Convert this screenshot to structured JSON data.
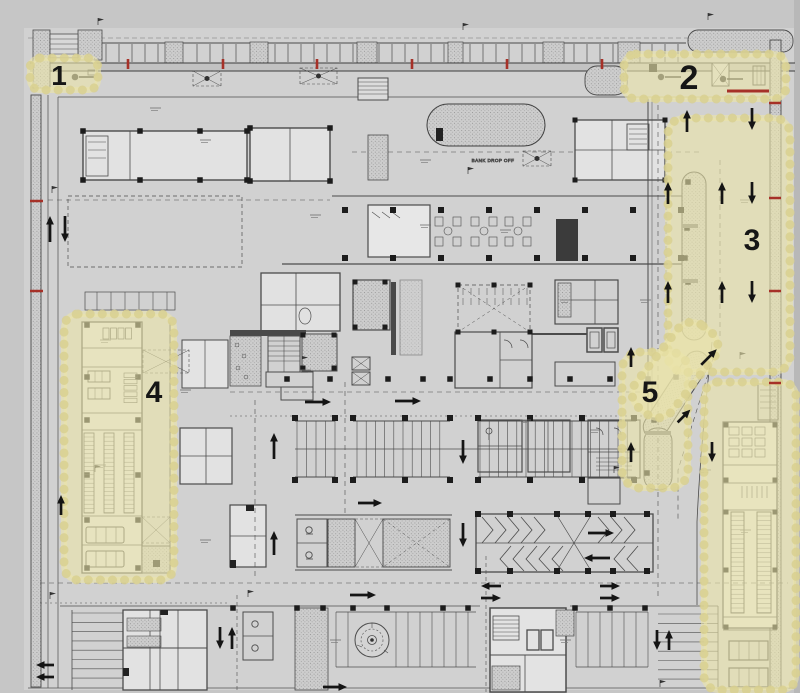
{
  "document": {
    "title": "Parking level floor plan with highlighted zones 1-5"
  },
  "colors": {
    "background": "#c6c6c6",
    "paper": "#d1d1d1",
    "room": "#e2e2e2",
    "line": "#4c4c4c",
    "wall": "#3a3a3a",
    "highlight_fill": "rgba(234,228,170,0.62)",
    "highlight_edge": "rgba(216,208,142,0.8)",
    "number": "#161616",
    "red": "#a63128",
    "arrow": "#141414"
  },
  "zones": [
    {
      "name": "highlight-zone-1",
      "label": "1",
      "x": 30,
      "y": 58,
      "w": 68,
      "h": 32,
      "rx": 10,
      "label_x": 59,
      "label_y": 85,
      "font": 28
    },
    {
      "name": "highlight-zone-2",
      "label": "2",
      "x": 624,
      "y": 54,
      "w": 162,
      "h": 45,
      "rx": 12,
      "label_x": 689,
      "label_y": 89,
      "font": 34
    },
    {
      "name": "highlight-zone-3",
      "label": "3",
      "x": 668,
      "y": 118,
      "w": 122,
      "h": 254,
      "rx": 16,
      "label_x": 752,
      "label_y": 250,
      "font": 30
    },
    {
      "name": "highlight-zone-4",
      "label": "4",
      "x": 64,
      "y": 314,
      "w": 110,
      "h": 266,
      "rx": 14,
      "label_x": 154,
      "label_y": 402,
      "font": 30
    },
    {
      "name": "highlight-zone-5",
      "label": "5",
      "x": 622,
      "y": 352,
      "w": 66,
      "h": 136,
      "rx": 18,
      "label_x": 650,
      "label_y": 402,
      "font": 30
    },
    {
      "name": "highlight-zone-5-arm",
      "label": "",
      "x": 652,
      "y": 318,
      "w": 46,
      "h": 104,
      "rx": 18,
      "rotate": 38
    },
    {
      "name": "highlight-right-strip",
      "label": "",
      "x": 704,
      "y": 382,
      "w": 92,
      "h": 308,
      "rx": 14
    }
  ],
  "plan_texts": [
    {
      "text": "BANK DROP OFF",
      "x": 493,
      "y": 162,
      "size": 4.6
    }
  ],
  "arrows": [
    {
      "dir": "up",
      "x": 50,
      "y": 229,
      "len": 26
    },
    {
      "dir": "down",
      "x": 65,
      "y": 229,
      "len": 26
    },
    {
      "dir": "up",
      "x": 687,
      "y": 121,
      "len": 22
    },
    {
      "dir": "down",
      "x": 752,
      "y": 119,
      "len": 22
    },
    {
      "dir": "up",
      "x": 668,
      "y": 193,
      "len": 22
    },
    {
      "dir": "up",
      "x": 722,
      "y": 193,
      "len": 22
    },
    {
      "dir": "down",
      "x": 752,
      "y": 193,
      "len": 22
    },
    {
      "dir": "up",
      "x": 668,
      "y": 292,
      "len": 22
    },
    {
      "dir": "up",
      "x": 722,
      "y": 292,
      "len": 22
    },
    {
      "dir": "down",
      "x": 752,
      "y": 292,
      "len": 22
    },
    {
      "dir": "up",
      "x": 631,
      "y": 357,
      "len": 20
    },
    {
      "dir": "ne",
      "x": 709,
      "y": 357,
      "len": 22
    },
    {
      "dir": "ne",
      "x": 684,
      "y": 416,
      "len": 18
    },
    {
      "dir": "up",
      "x": 631,
      "y": 452,
      "len": 20
    },
    {
      "dir": "down",
      "x": 712,
      "y": 452,
      "len": 20
    },
    {
      "dir": "up",
      "x": 274,
      "y": 446,
      "len": 26
    },
    {
      "dir": "up",
      "x": 274,
      "y": 543,
      "len": 24
    },
    {
      "dir": "right",
      "x": 318,
      "y": 402,
      "len": 26
    },
    {
      "dir": "right",
      "x": 408,
      "y": 401,
      "len": 26
    },
    {
      "dir": "down",
      "x": 463,
      "y": 452,
      "len": 24
    },
    {
      "dir": "down",
      "x": 463,
      "y": 535,
      "len": 24
    },
    {
      "dir": "right",
      "x": 370,
      "y": 503,
      "len": 24
    },
    {
      "dir": "right",
      "x": 601,
      "y": 533,
      "len": 26
    },
    {
      "dir": "left",
      "x": 597,
      "y": 558,
      "len": 26
    },
    {
      "dir": "left",
      "x": 491,
      "y": 586,
      "len": 20
    },
    {
      "dir": "right",
      "x": 491,
      "y": 598,
      "len": 20
    },
    {
      "dir": "right",
      "x": 610,
      "y": 586,
      "len": 20
    },
    {
      "dir": "right",
      "x": 610,
      "y": 598,
      "len": 20
    },
    {
      "dir": "right",
      "x": 363,
      "y": 595,
      "len": 26
    },
    {
      "dir": "right",
      "x": 335,
      "y": 687,
      "len": 24
    },
    {
      "dir": "left",
      "x": 45,
      "y": 665,
      "len": 18
    },
    {
      "dir": "left",
      "x": 45,
      "y": 677,
      "len": 18
    },
    {
      "dir": "down",
      "x": 220,
      "y": 638,
      "len": 22
    },
    {
      "dir": "up",
      "x": 232,
      "y": 638,
      "len": 22
    },
    {
      "dir": "down",
      "x": 657,
      "y": 640,
      "len": 20
    },
    {
      "dir": "up",
      "x": 669,
      "y": 640,
      "len": 20
    },
    {
      "dir": "up",
      "x": 61,
      "y": 505,
      "len": 20
    }
  ],
  "red_marks": [
    {
      "x1": 128,
      "y1": 59,
      "x2": 128,
      "y2": 69,
      "w": 2.6
    },
    {
      "x1": 223,
      "y1": 59,
      "x2": 223,
      "y2": 69,
      "w": 2.6
    },
    {
      "x1": 317,
      "y1": 59,
      "x2": 317,
      "y2": 69,
      "w": 2.6
    },
    {
      "x1": 412,
      "y1": 59,
      "x2": 412,
      "y2": 69,
      "w": 2.6
    },
    {
      "x1": 507,
      "y1": 59,
      "x2": 507,
      "y2": 69,
      "w": 2.6
    },
    {
      "x1": 602,
      "y1": 59,
      "x2": 602,
      "y2": 69,
      "w": 2.6
    },
    {
      "x1": 727,
      "y1": 91,
      "x2": 769,
      "y2": 91,
      "w": 3
    },
    {
      "x1": 30,
      "y1": 201,
      "x2": 43,
      "y2": 201,
      "w": 2.5
    },
    {
      "x1": 30,
      "y1": 291,
      "x2": 43,
      "y2": 291,
      "w": 2.5
    },
    {
      "x1": 769,
      "y1": 103,
      "x2": 781,
      "y2": 103,
      "w": 2.5
    },
    {
      "x1": 769,
      "y1": 198,
      "x2": 781,
      "y2": 198,
      "w": 2.5
    },
    {
      "x1": 769,
      "y1": 291,
      "x2": 781,
      "y2": 291,
      "w": 2.5
    },
    {
      "x1": 769,
      "y1": 383,
      "x2": 781,
      "y2": 383,
      "w": 2.5
    }
  ]
}
